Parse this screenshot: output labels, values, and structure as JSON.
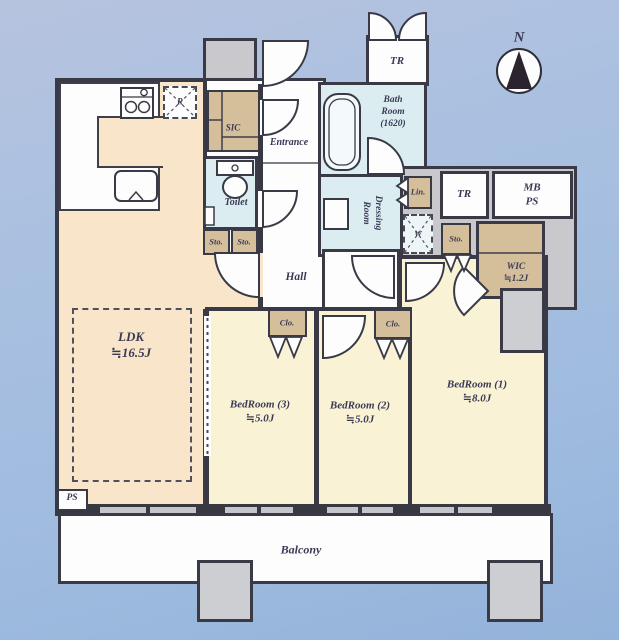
{
  "compass": {
    "label": "N"
  },
  "rooms": {
    "ldk": {
      "name": "LDK",
      "area": "≒16.5J"
    },
    "bedroom1": {
      "name": "BedRoom (1)",
      "area": "≒8.0J"
    },
    "bedroom2": {
      "name": "BedRoom (2)",
      "area": "≒5.0J"
    },
    "bedroom3": {
      "name": "BedRoom (3)",
      "area": "≒5.0J"
    },
    "balcony": {
      "name": "Balcony"
    },
    "hall": {
      "name": "Hall"
    },
    "entrance": {
      "name": "Entrance"
    },
    "toilet": {
      "name": "Toilet"
    },
    "bathroom": {
      "name": "Bath Room (1620)"
    },
    "dressing": {
      "name": "Dressing Room"
    },
    "wic": {
      "name": "WIC",
      "area": "≒1.2J"
    },
    "sic": {
      "name": "SIC"
    }
  },
  "storage": {
    "sto": "Sto.",
    "clo": "Clo.",
    "lin": "Lin.",
    "tr": "TR",
    "mbps": "MB PS",
    "ps": "PS",
    "washer": "W",
    "fridge": "R"
  },
  "colors": {
    "background_blue": "#a9c0e0",
    "wall": "#3a3a46",
    "ldk_floor": "#f8e5ca",
    "bedroom_floor": "#f9f2d5",
    "wet_area": "#dcedf2",
    "closet_tan": "#d5bf9b",
    "concrete_gray": "#c9c9cd"
  }
}
